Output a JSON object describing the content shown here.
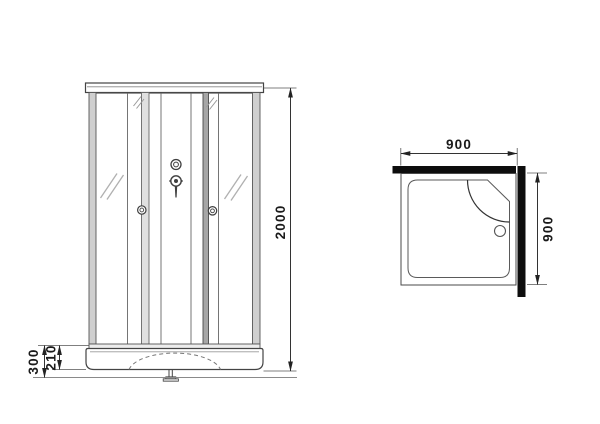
{
  "drawing": {
    "type": "shower-cabin-technical-drawing",
    "views": {
      "front": "front-elevation",
      "top": "plan-view"
    }
  },
  "dimensions": {
    "front": {
      "height": "2000",
      "base_total": "300",
      "base_inner": "210"
    },
    "top": {
      "width": "900",
      "depth": "900"
    }
  },
  "icons": {
    "drain_icon": "circle-outline",
    "mixer_icon": "knob-with-stem",
    "door_handle_icon": "ring"
  },
  "colors": {
    "wall": "#0d0d0d",
    "line": "#3f3f3f",
    "dim": "#222222"
  }
}
